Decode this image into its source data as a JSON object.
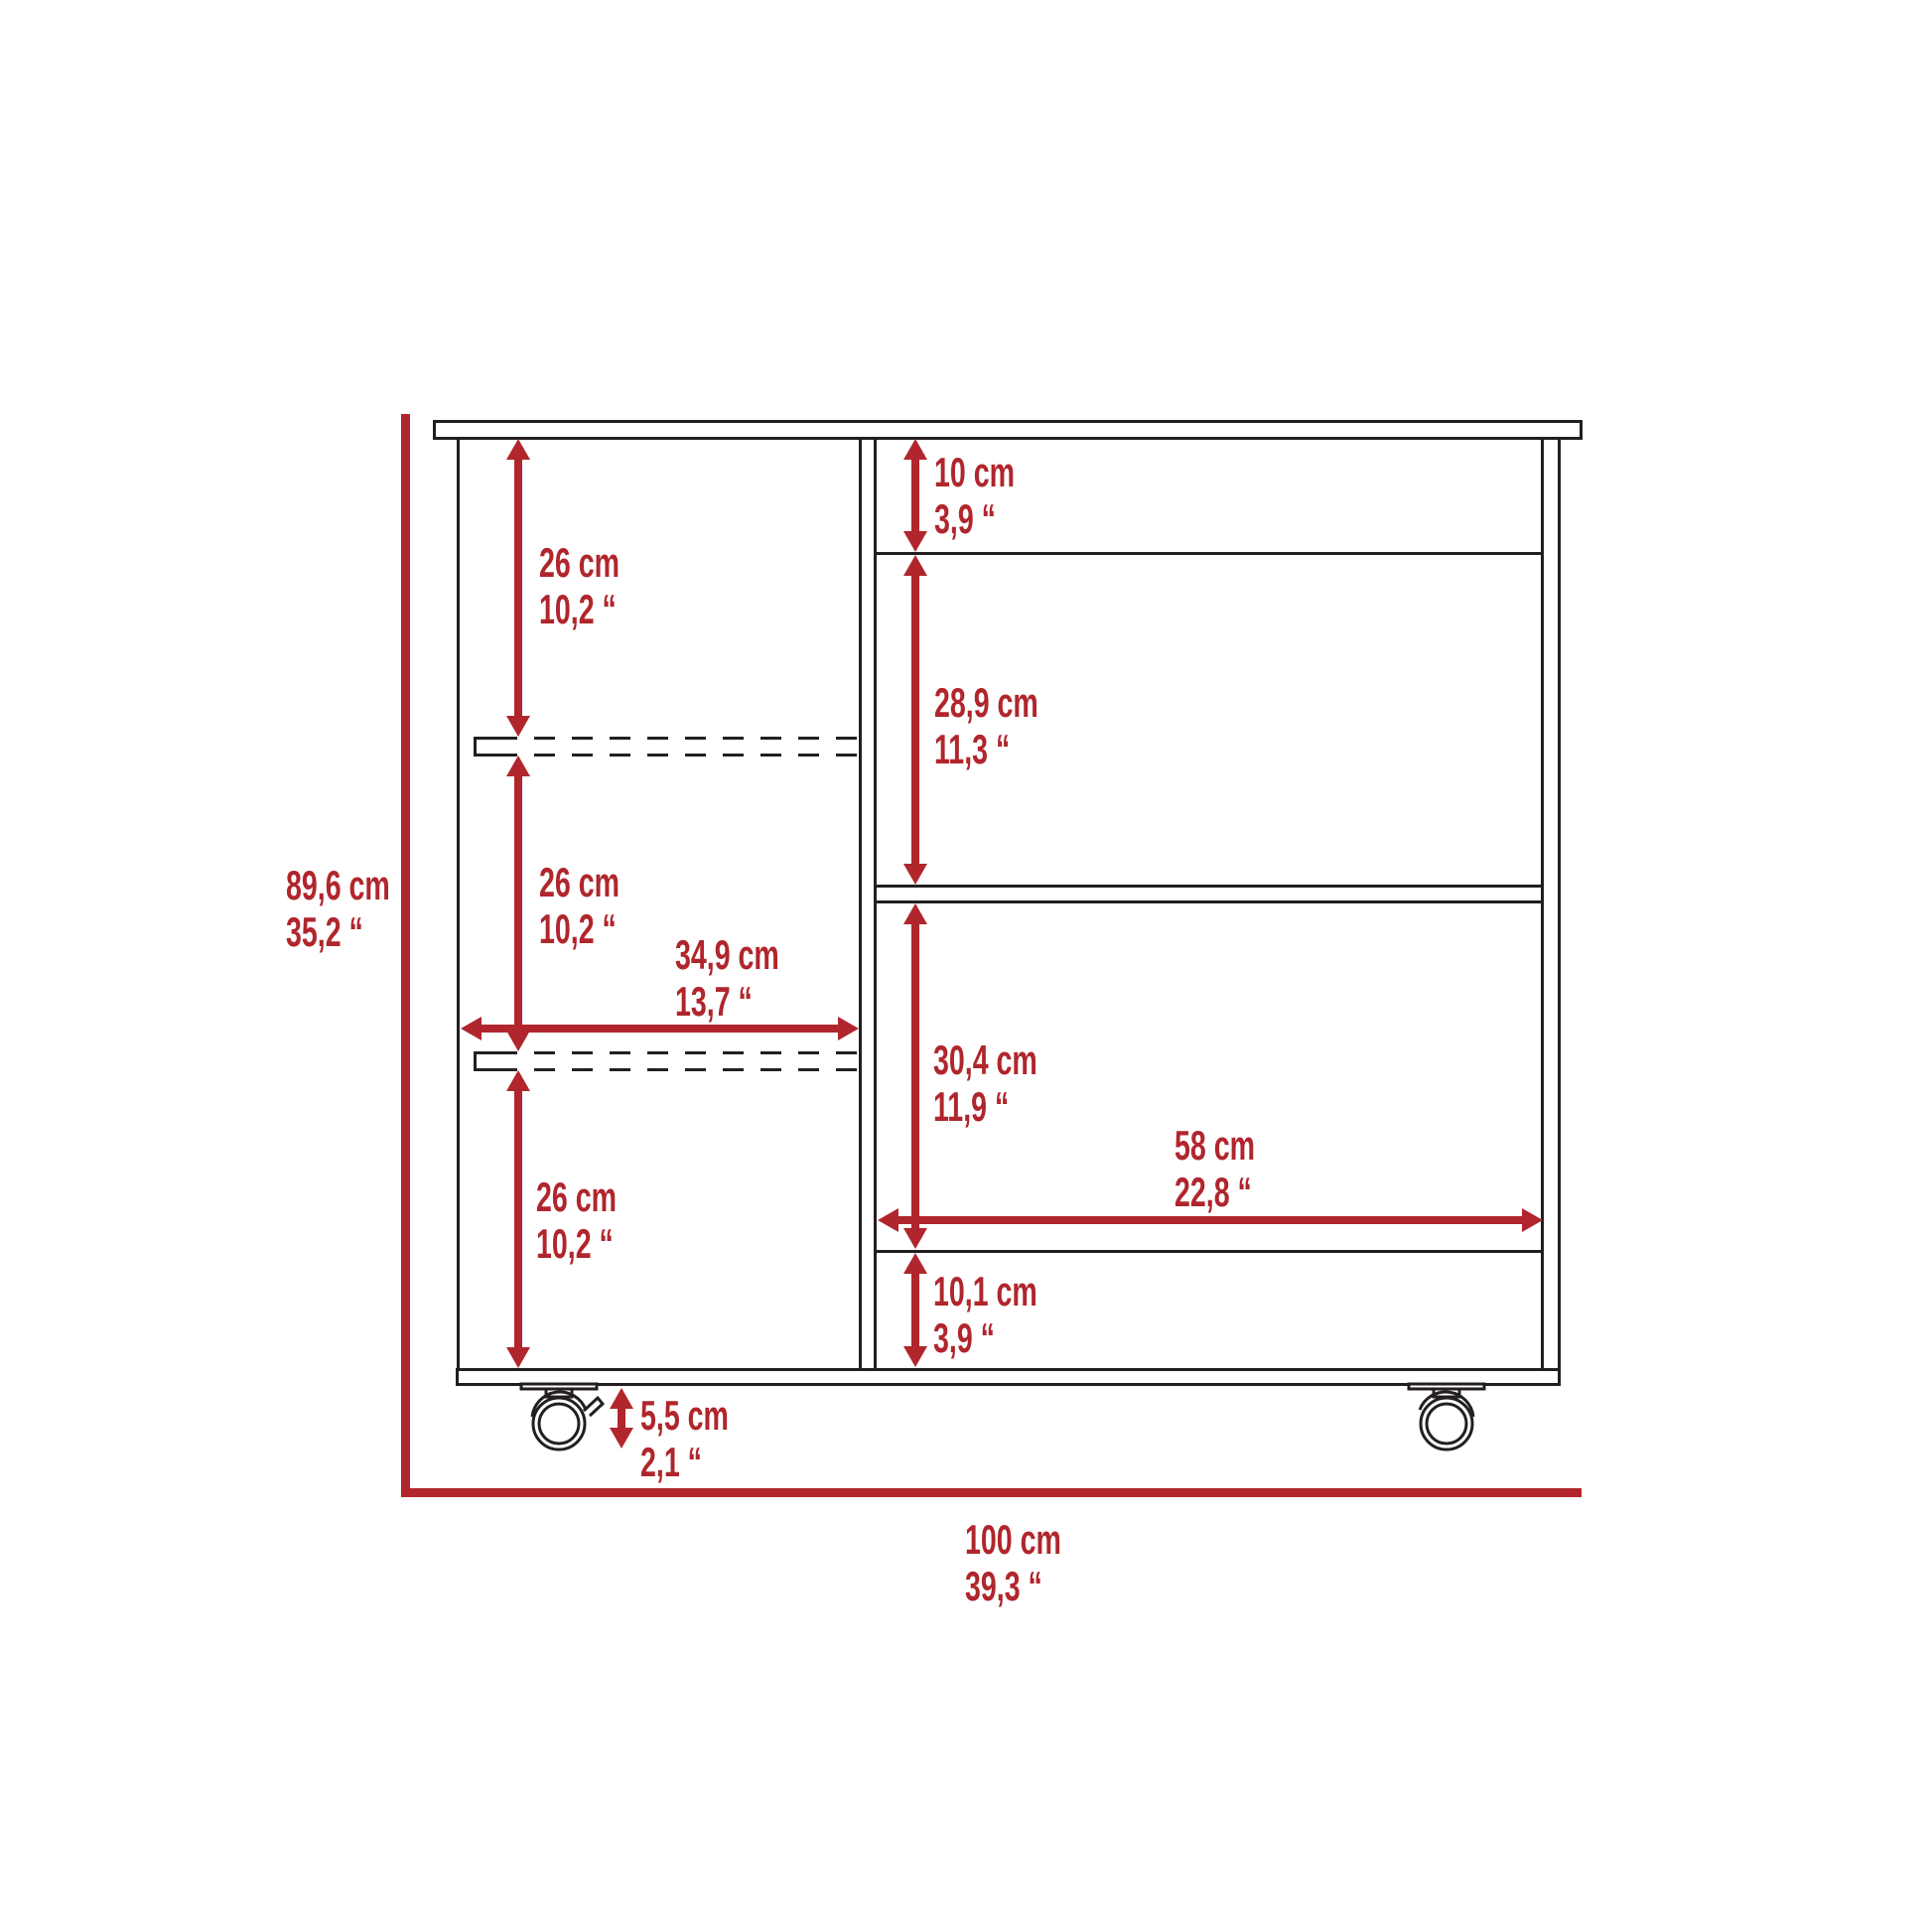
{
  "colors": {
    "dimension_red": "#B0262C",
    "line_black": "#231F20",
    "background": "#FFFFFF"
  },
  "diagram": {
    "type": "furniture-dimension-drawing",
    "object": "bar-cart front elevation with shelves, bottle slots and casters",
    "dimensions": {
      "overall_height": {
        "cm": "89,6 cm",
        "inch": "35,2 “"
      },
      "overall_width": {
        "cm": "100 cm",
        "inch": "39,3 “"
      },
      "left_shelf_top": {
        "cm": "26 cm",
        "inch": "10,2 “"
      },
      "left_shelf_middle": {
        "cm": "26 cm",
        "inch": "10,2 “"
      },
      "left_shelf_bottom": {
        "cm": "26 cm",
        "inch": "10,2 “"
      },
      "left_section_width": {
        "cm": "34,9 cm",
        "inch": "13,7 “"
      },
      "right_top_gap": {
        "cm": "10 cm",
        "inch": "3,9 “"
      },
      "right_shelf_upper": {
        "cm": "28,9 cm",
        "inch": "11,3 “"
      },
      "right_shelf_lower": {
        "cm": "30,4 cm",
        "inch": "11,9 “"
      },
      "right_section_width": {
        "cm": "58 cm",
        "inch": "22,8 “"
      },
      "right_bottom_gap": {
        "cm": "10,1 cm",
        "inch": "3,9 “"
      },
      "caster_height": {
        "cm": "5,5 cm",
        "inch": "2,1 “"
      }
    }
  }
}
